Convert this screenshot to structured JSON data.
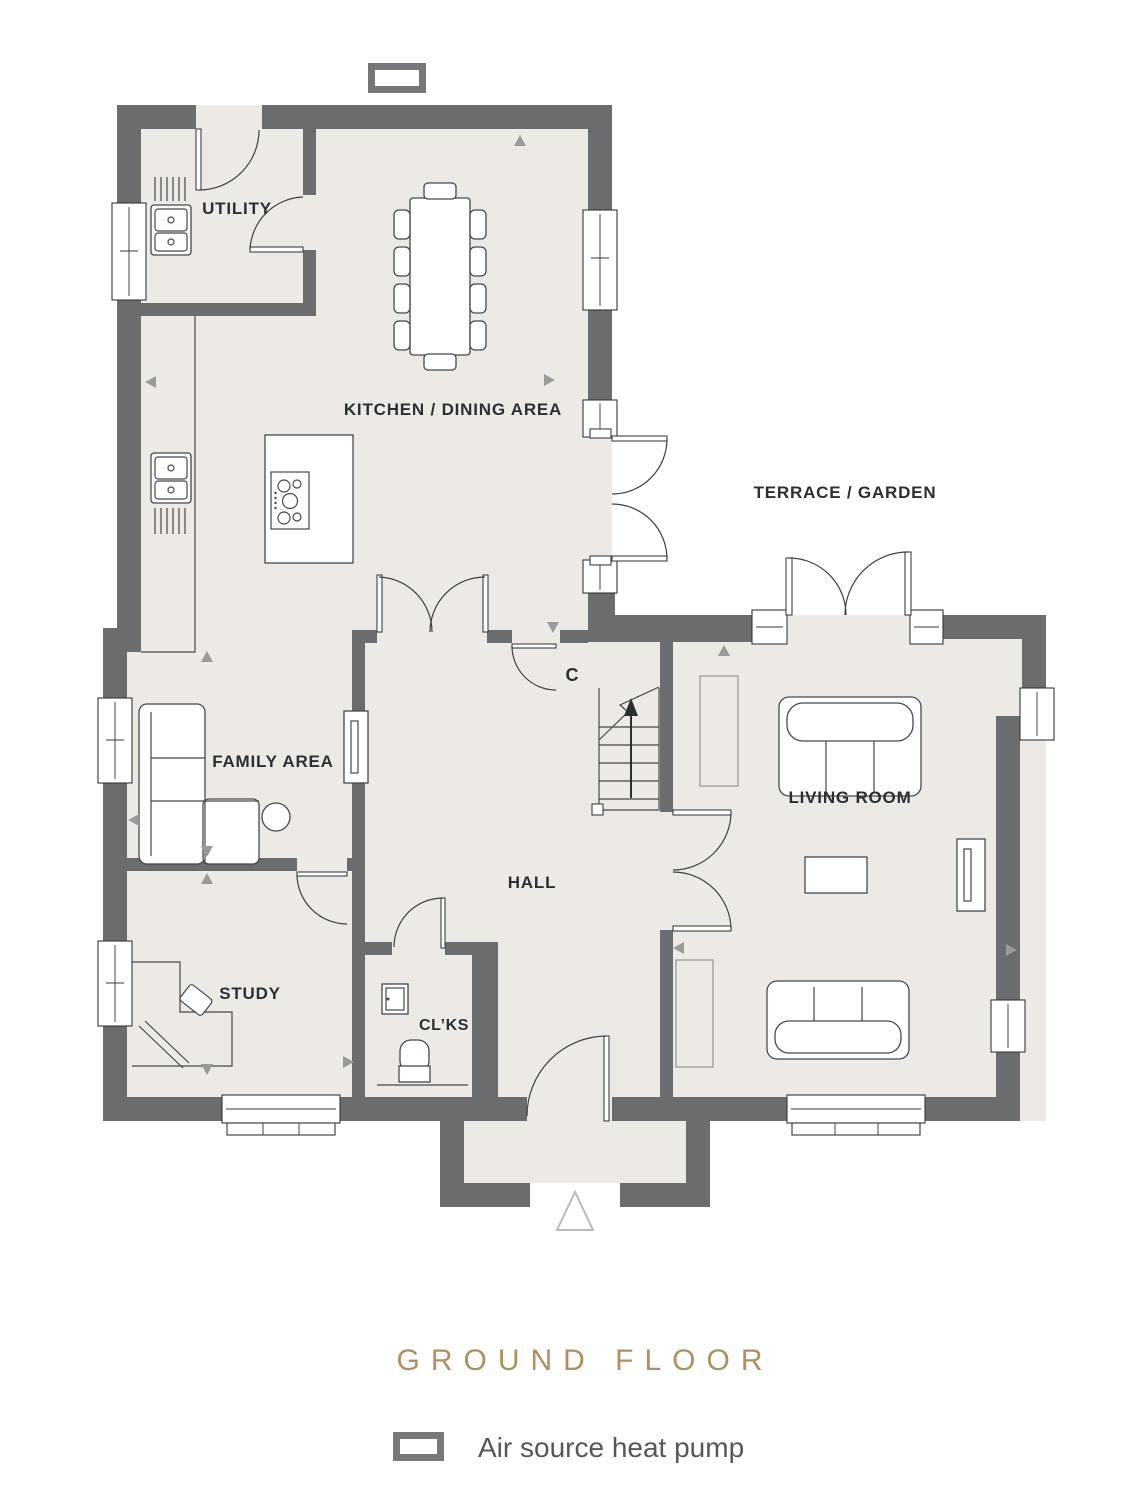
{
  "plan": {
    "rooms": [
      {
        "id": "utility",
        "label": "UTILITY"
      },
      {
        "id": "kitchen-dining",
        "label": "KITCHEN / DINING AREA"
      },
      {
        "id": "terrace-garden",
        "label": "TERRACE / GARDEN"
      },
      {
        "id": "family-area",
        "label": "FAMILY AREA"
      },
      {
        "id": "living-room",
        "label": "LIVING ROOM"
      },
      {
        "id": "hall",
        "label": "HALL"
      },
      {
        "id": "stairs-cupboard",
        "label": "C"
      },
      {
        "id": "study",
        "label": "STUDY"
      },
      {
        "id": "cloakroom",
        "label": "CL’KS"
      }
    ],
    "symbols": {
      "heat_pump": "rect-outline",
      "entrance": "triangle-outline",
      "stairs_direction": "arrow-up"
    }
  },
  "footer": {
    "title": "GROUND FLOOR",
    "legend": {
      "symbol": "heat-pump-rect-icon",
      "label": "Air source heat pump"
    }
  },
  "colors": {
    "wall": "#6b6c6e",
    "floor": "#edeae6",
    "title_accent": "#b18f60",
    "label_text": "#2c2f32",
    "legend_text": "#55585b",
    "marker": "#9a9a9a"
  }
}
